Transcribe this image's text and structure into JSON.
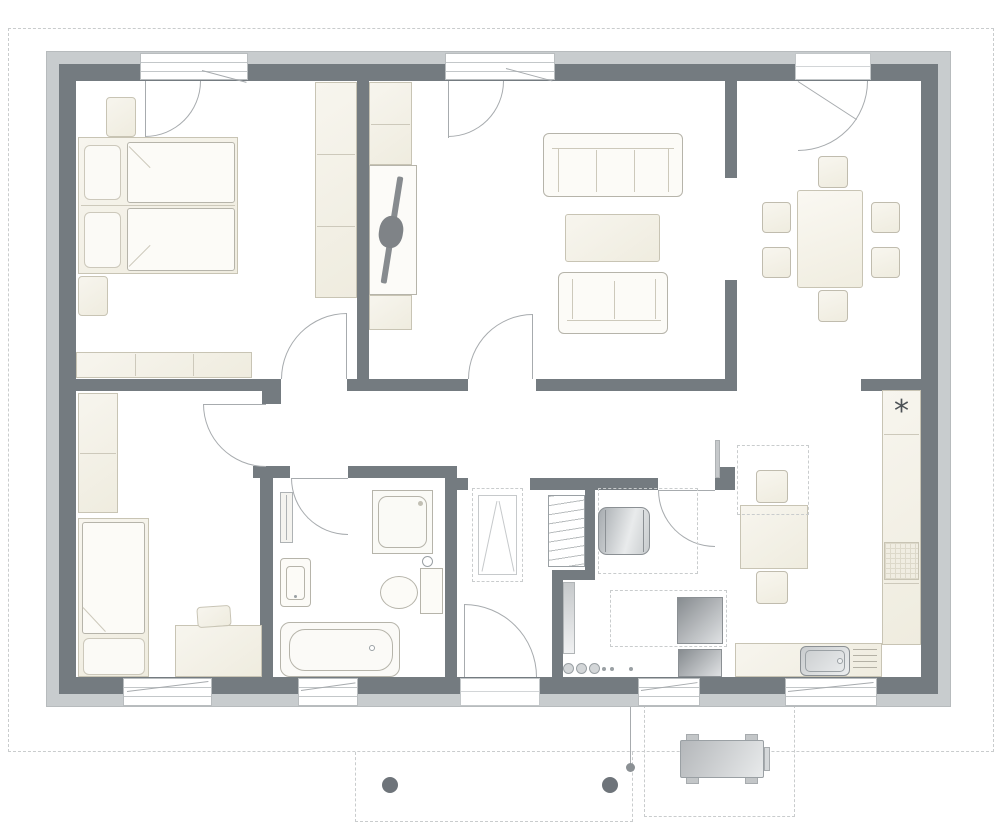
{
  "plan": {
    "type": "architectural-floor-plan",
    "building": "single-storey house, top-down view",
    "rooms": [
      {
        "id": "bedroom-1",
        "position": "top-left",
        "furniture": [
          "double-bed",
          "pillow",
          "pillow",
          "duvet",
          "duvet",
          "nightstand",
          "nightstand",
          "side-wardrobe",
          "low-sideboard"
        ],
        "openings": [
          "top-window",
          "door-to-hallway"
        ]
      },
      {
        "id": "living-room",
        "position": "top-center",
        "furniture": [
          "tall-cabinet",
          "tv-panel",
          "tv",
          "low-cabinet",
          "large-sofa",
          "coffee-table",
          "small-sofa"
        ],
        "openings": [
          "top-window",
          "door-to-hallway",
          "opening-to-dining"
        ]
      },
      {
        "id": "dining-room",
        "position": "top-right",
        "furniture": [
          "dining-table",
          "chair",
          "chair",
          "chair",
          "chair",
          "chair",
          "chair"
        ],
        "openings": [
          "exterior-door-top",
          "opening-to-living",
          "opening-to-kitchen"
        ]
      },
      {
        "id": "bedroom-2",
        "position": "bottom-left",
        "furniture": [
          "wardrobe",
          "single-bed",
          "duvet",
          "pillow",
          "desk",
          "desk-chair"
        ],
        "openings": [
          "bottom-window",
          "door-to-hallway"
        ]
      },
      {
        "id": "bathroom",
        "position": "bottom-center-left",
        "furniture": [
          "radiator",
          "washbasin",
          "shower",
          "toilet",
          "bathtub"
        ],
        "openings": [
          "bottom-window",
          "door-to-hallway"
        ]
      },
      {
        "id": "entry-hall",
        "position": "bottom-center",
        "furniture": [
          "attic-ladder-hatch",
          "ladder-radiator"
        ],
        "openings": [
          "entrance-door-bottom",
          "opening-to-hallway"
        ]
      },
      {
        "id": "technical-room",
        "position": "bottom-center-right",
        "furniture": [
          "water-heater",
          "washing-machine",
          "dryer",
          "pipe-chase",
          "utility-connections"
        ],
        "openings": [
          "bottom-window",
          "door-to-hallway"
        ]
      },
      {
        "id": "kitchen",
        "position": "bottom-right",
        "furniture": [
          "tall-unit-with-freezer",
          "hob",
          "counter-run",
          "sink-with-drainer",
          "kitchen-table",
          "chair",
          "chair",
          "open-door-leaf"
        ],
        "openings": [
          "bottom-window",
          "door-to-hallway",
          "opening-to-dining"
        ]
      }
    ],
    "exterior": {
      "roof_outline": "dashed rectangle around house",
      "porch_posts": 2,
      "terrace": "dashed rectangle with garden bench",
      "downpipe": 1
    }
  },
  "symbols": {
    "freezer_asterisk": "*"
  },
  "palette": {
    "wall_dark": "#747b80",
    "wall_light": "#c8ccce",
    "furniture_cream": "#f2efe4",
    "furniture_line": "#c8c4b4",
    "thin_line": "#a7abae",
    "dashed_line": "#c9cccd",
    "appliance_dark": "#878c90",
    "paper": "#ffffff"
  }
}
